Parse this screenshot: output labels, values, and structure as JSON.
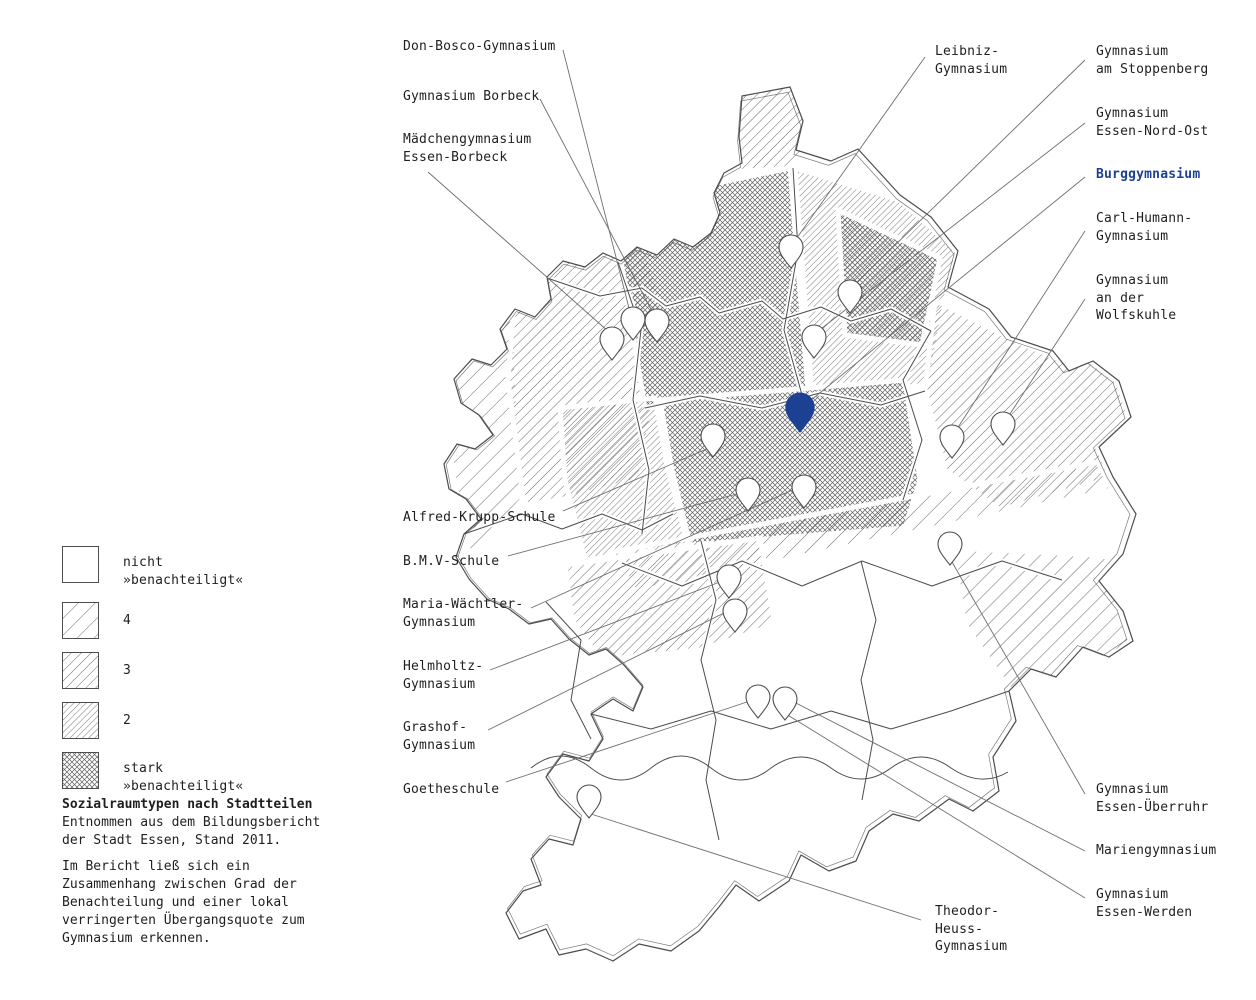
{
  "colors": {
    "accent": "#1c4192",
    "map_line": "#4d4d4d",
    "hatch_line": "#666666",
    "leader_line": "#6e6e6e",
    "text": "#1f1f1f"
  },
  "legend": {
    "items": [
      {
        "id": "legend-none",
        "pattern": "none",
        "label": "nicht\n»benachteiligt«"
      },
      {
        "id": "legend-4",
        "pattern": "pat4",
        "label": "4"
      },
      {
        "id": "legend-3",
        "pattern": "pat3",
        "label": "3"
      },
      {
        "id": "legend-2",
        "pattern": "pat2",
        "label": "2"
      },
      {
        "id": "legend-stark",
        "pattern": "patstark",
        "label": "stark\n»benachteiligt«"
      }
    ]
  },
  "note": {
    "title": "Sozialraumtypen nach Stadtteilen",
    "lines": "Entnommen aus dem Bildungsbericht\nder Stadt Essen, Stand 2011.",
    "para2": "Im Bericht ließ sich ein\nZusammenhang zwischen Grad der\nBenachteilung und einer lokal\nverringerten Übergangsquote zum\nGymnasium erkennen."
  },
  "map": {
    "labels": [
      {
        "id": "don-bosco",
        "text": "Don-Bosco-Gymnasium",
        "x": 403,
        "y": 38,
        "highlight": false
      },
      {
        "id": "gym-borbeck",
        "text": "Gymnasium Borbeck",
        "x": 403,
        "y": 88,
        "highlight": false
      },
      {
        "id": "maedchengym",
        "text": "Mädchengymnasium\nEssen-Borbeck",
        "x": 403,
        "y": 131,
        "highlight": false
      },
      {
        "id": "leibniz",
        "text": "Leibniz-\nGymnasium",
        "x": 935,
        "y": 43,
        "highlight": false
      },
      {
        "id": "stoppenberg",
        "text": "Gymnasium\nam Stoppenberg",
        "x": 1096,
        "y": 43,
        "highlight": false
      },
      {
        "id": "nord-ost",
        "text": "Gymnasium\nEssen-Nord-Ost",
        "x": 1096,
        "y": 105,
        "highlight": false
      },
      {
        "id": "burg",
        "text": "Burggymnasium",
        "x": 1096,
        "y": 166,
        "highlight": true
      },
      {
        "id": "carl-humann",
        "text": "Carl-Humann-\nGymnasium",
        "x": 1096,
        "y": 210,
        "highlight": false
      },
      {
        "id": "wolfskuhle",
        "text": "Gymnasium\nan der\nWolfskuhle",
        "x": 1096,
        "y": 272,
        "highlight": false
      },
      {
        "id": "alfred-krupp",
        "text": "Alfred-Krupp-Schule",
        "x": 403,
        "y": 509,
        "highlight": false
      },
      {
        "id": "bmv",
        "text": "B.M.V-Schule",
        "x": 403,
        "y": 553,
        "highlight": false
      },
      {
        "id": "maria-waechtler",
        "text": "Maria-Wächtler-\nGymnasium",
        "x": 403,
        "y": 596,
        "highlight": false
      },
      {
        "id": "helmholtz",
        "text": "Helmholtz-\nGymnasium",
        "x": 403,
        "y": 658,
        "highlight": false
      },
      {
        "id": "grashof",
        "text": "Grashof-\nGymnasium",
        "x": 403,
        "y": 719,
        "highlight": false
      },
      {
        "id": "goetheschule",
        "text": "Goetheschule",
        "x": 403,
        "y": 781,
        "highlight": false
      },
      {
        "id": "ueberruhr",
        "text": "Gymnasium\nEssen-Überruhr",
        "x": 1096,
        "y": 781,
        "highlight": false
      },
      {
        "id": "marien",
        "text": "Mariengymnasium",
        "x": 1096,
        "y": 842,
        "highlight": false
      },
      {
        "id": "werden",
        "text": "Gymnasium\nEssen-Werden",
        "x": 1096,
        "y": 886,
        "highlight": false
      },
      {
        "id": "theodor-heuss",
        "text": "Theodor-\nHeuss-\nGymnasium",
        "x": 935,
        "y": 903,
        "highlight": false
      }
    ],
    "pins": [
      {
        "id": "pin-don-bosco",
        "x": 633,
        "y": 340,
        "highlight": false
      },
      {
        "id": "pin-gym-borbeck",
        "x": 657,
        "y": 342,
        "highlight": false
      },
      {
        "id": "pin-maedchengym",
        "x": 612,
        "y": 360,
        "highlight": false
      },
      {
        "id": "pin-leibniz",
        "x": 791,
        "y": 268,
        "highlight": false
      },
      {
        "id": "pin-stoppenberg",
        "x": 850,
        "y": 313,
        "highlight": false
      },
      {
        "id": "pin-nord-ost",
        "x": 814,
        "y": 358,
        "highlight": false
      },
      {
        "id": "pin-burg",
        "x": 800,
        "y": 432,
        "highlight": true
      },
      {
        "id": "pin-carl-humann",
        "x": 952,
        "y": 458,
        "highlight": false
      },
      {
        "id": "pin-wolfskuhle",
        "x": 1003,
        "y": 445,
        "highlight": false
      },
      {
        "id": "pin-alfred-krupp",
        "x": 713,
        "y": 457,
        "highlight": false
      },
      {
        "id": "pin-bmv",
        "x": 748,
        "y": 511,
        "highlight": false
      },
      {
        "id": "pin-maria-waechtler",
        "x": 804,
        "y": 508,
        "highlight": false
      },
      {
        "id": "pin-helmholtz",
        "x": 729,
        "y": 598,
        "highlight": false
      },
      {
        "id": "pin-grashof",
        "x": 735,
        "y": 632,
        "highlight": false
      },
      {
        "id": "pin-goetheschule",
        "x": 758,
        "y": 718,
        "highlight": false
      },
      {
        "id": "pin-werden",
        "x": 785,
        "y": 720,
        "highlight": false
      },
      {
        "id": "pin-theodor-heuss",
        "x": 589,
        "y": 818,
        "highlight": false
      },
      {
        "id": "pin-ueberruhr",
        "x": 950,
        "y": 565,
        "highlight": false
      }
    ],
    "leaders": [
      {
        "id": "leader-don-bosco",
        "x1": 563,
        "y1": 50,
        "x2": 630,
        "y2": 312
      },
      {
        "id": "leader-gym-borbeck",
        "x1": 540,
        "y1": 99,
        "x2": 654,
        "y2": 315
      },
      {
        "id": "leader-maedchengym",
        "x1": 428,
        "y1": 172,
        "x2": 609,
        "y2": 332
      },
      {
        "id": "leader-leibniz",
        "x1": 925,
        "y1": 57,
        "x2": 794,
        "y2": 242
      },
      {
        "id": "leader-stoppenberg",
        "x1": 1085,
        "y1": 60,
        "x2": 852,
        "y2": 287
      },
      {
        "id": "leader-nord-ost",
        "x1": 1085,
        "y1": 123,
        "x2": 817,
        "y2": 332
      },
      {
        "id": "leader-burg",
        "x1": 1085,
        "y1": 177,
        "x2": 805,
        "y2": 405
      },
      {
        "id": "leader-carl-humann",
        "x1": 1085,
        "y1": 231,
        "x2": 955,
        "y2": 432
      },
      {
        "id": "leader-wolfskuhle",
        "x1": 1085,
        "y1": 299,
        "x2": 1006,
        "y2": 420
      },
      {
        "id": "leader-alfred-krupp",
        "x1": 563,
        "y1": 511,
        "x2": 709,
        "y2": 448
      },
      {
        "id": "leader-bmv",
        "x1": 508,
        "y1": 556,
        "x2": 744,
        "y2": 492
      },
      {
        "id": "leader-maria-waechtler",
        "x1": 531,
        "y1": 608,
        "x2": 799,
        "y2": 487
      },
      {
        "id": "leader-helmholtz",
        "x1": 490,
        "y1": 670,
        "x2": 725,
        "y2": 580
      },
      {
        "id": "leader-grashof",
        "x1": 488,
        "y1": 730,
        "x2": 730,
        "y2": 610
      },
      {
        "id": "leader-goetheschule",
        "x1": 506,
        "y1": 782,
        "x2": 753,
        "y2": 700
      },
      {
        "id": "leader-ueberruhr",
        "x1": 1085,
        "y1": 794,
        "x2": 952,
        "y2": 562
      },
      {
        "id": "leader-marien",
        "x1": 1085,
        "y1": 851,
        "x2": 790,
        "y2": 700
      },
      {
        "id": "leader-werden",
        "x1": 1085,
        "y1": 898,
        "x2": 786,
        "y2": 714
      },
      {
        "id": "leader-theodor-heuss",
        "x1": 921,
        "y1": 920,
        "x2": 591,
        "y2": 814
      }
    ]
  }
}
